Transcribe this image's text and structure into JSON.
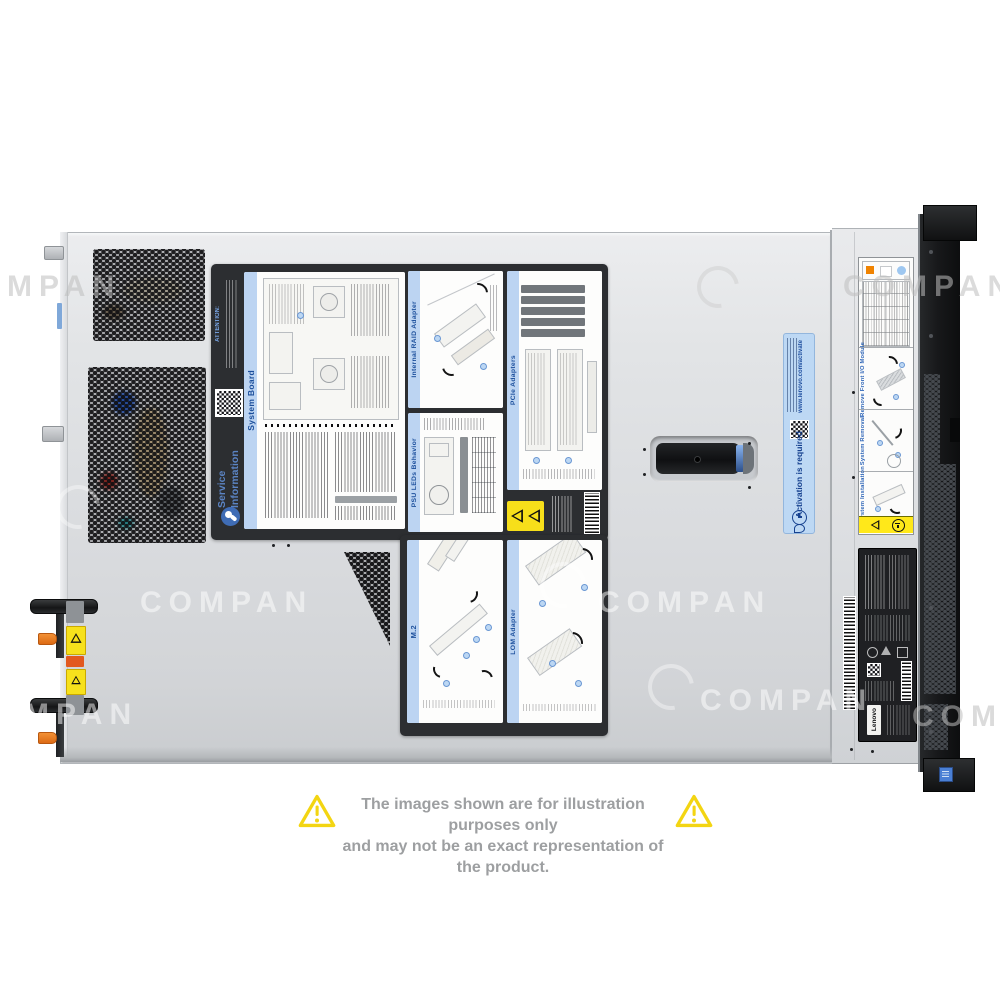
{
  "product_photo": {
    "description": "Top view of a Lenovo rack server chassis with service labels",
    "brand": "Lenovo"
  },
  "watermark": {
    "text": "COMPAN"
  },
  "service_label": {
    "attention_heading": "ATTENTION:",
    "info_title_line1": "Service",
    "info_title_line2": "Information",
    "panels": [
      {
        "title": "System Board"
      },
      {
        "title": "Internal RAID Adapter"
      },
      {
        "title": "PCIe Adapters"
      },
      {
        "title": "PSU LEDs Behavior"
      },
      {
        "title": "M.2"
      },
      {
        "title": "LOM Adapter"
      }
    ]
  },
  "activation_sticker": {
    "title": "Activation is required",
    "url": "www.lenovo.com/activate"
  },
  "rear_service_card": {
    "sections": [
      {
        "title": "Remove Front I/O Module"
      },
      {
        "title": "System Removal"
      },
      {
        "title": "System Installation"
      }
    ]
  },
  "regulatory_label": {
    "brand": "Lenovo"
  },
  "disclaimer": {
    "line1": "The images shown are for illustration purposes only",
    "line2": "and may not be an exact representation of the product."
  },
  "colors": {
    "panel_header_blue": "#bcd4f2",
    "panel_title_blue": "#1c4f9c",
    "sticker_blue": "#bdd8f4",
    "warning_yellow": "#f7df1a",
    "latch_orange": "#e8761f",
    "chassis_gray": "#dde0e3",
    "bezel_black": "#17181a",
    "disclaimer_gray": "#9d9fa1",
    "triangle_yellow": "#f3d512"
  }
}
